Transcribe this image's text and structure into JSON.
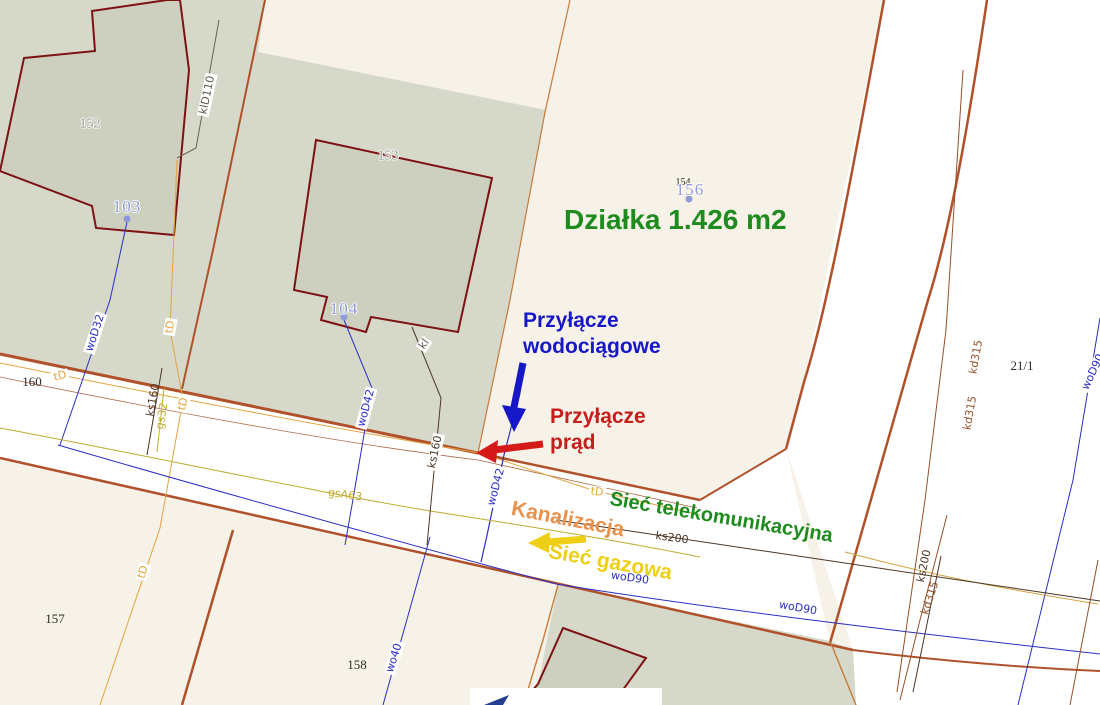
{
  "map": {
    "colors": {
      "plot_green": "#1d8b1d",
      "water_blue": "#1617c6",
      "power_red": "#c81d1d",
      "gas_yellow": "#eecf15",
      "sewer_orange": "#e8914a",
      "telecom_green": "#1d8b1d",
      "water_line": "#2a2ec0",
      "gas_line": "#bfab2e",
      "telecom_line": "#e2a43f",
      "sewer_line": "#4a3626",
      "storm_brown": "#94502a",
      "boundary_brown": "#b0512b",
      "dark": "#5f574b",
      "parcel_gray": "#98978d",
      "address_blue": "#8f9ad8",
      "black": "#2e2b28"
    },
    "annotations": [
      {
        "t": "Działka 1.426 m2",
        "x": 564,
        "y": 203,
        "c": "plot_green",
        "cls": "ann big",
        "name": "plot-area-label"
      },
      {
        "t": "Przyłącze\nwodociągowe",
        "x": 523,
        "y": 308,
        "c": "water_blue",
        "cls": "ann",
        "name": "water-connection-label"
      },
      {
        "t": "Przyłącze\nprąd",
        "x": 550,
        "y": 404,
        "c": "power_red",
        "cls": "ann",
        "name": "power-connection-label"
      },
      {
        "t": "Sieć telekomunikacyjna",
        "x": 612,
        "y": 487,
        "r": 9.5,
        "c": "telecom_green",
        "cls": "ann mid",
        "name": "telecom-network-label"
      },
      {
        "t": "Kanalizacja",
        "x": 514,
        "y": 496,
        "r": 11,
        "c": "sewer_orange",
        "cls": "ann",
        "name": "sewer-network-label"
      },
      {
        "t": "Sieć gazowa",
        "x": 551,
        "y": 539,
        "r": 10,
        "c": "gas_yellow",
        "cls": "ann",
        "name": "gas-network-label"
      }
    ],
    "labels": [
      {
        "t": "klD110",
        "x": 207,
        "y": 95,
        "r": -78,
        "c": "dark",
        "cls": "small chip",
        "name": "utility-label-kld110"
      },
      {
        "t": "kl",
        "x": 424,
        "y": 344,
        "r": -55,
        "c": "dark",
        "cls": "small chip",
        "name": "utility-label-kl"
      },
      {
        "t": "tD",
        "x": 60,
        "y": 376,
        "r": -15,
        "c": "telecom_line",
        "cls": "small chip",
        "name": "utility-label-td"
      },
      {
        "t": "tD",
        "x": 170,
        "y": 327,
        "r": -80,
        "c": "telecom_line",
        "cls": "small chip",
        "name": "utility-label-td"
      },
      {
        "t": "tD",
        "x": 183,
        "y": 404,
        "r": -75,
        "c": "telecom_line",
        "cls": "small chip",
        "name": "utility-label-td"
      },
      {
        "t": "tD",
        "x": 143,
        "y": 572,
        "r": -72,
        "c": "telecom_line",
        "cls": "small chip",
        "name": "utility-label-td"
      },
      {
        "t": "tD",
        "x": 597,
        "y": 492,
        "r": 8,
        "c": "telecom_line",
        "cls": "small chip",
        "name": "utility-label-td"
      },
      {
        "t": "woD32",
        "x": 95,
        "y": 333,
        "r": -72,
        "c": "water_line",
        "cls": "small chip",
        "name": "utility-label-wod32"
      },
      {
        "t": "woD42",
        "x": 366,
        "y": 408,
        "r": -75,
        "c": "water_line",
        "cls": "small chip",
        "name": "utility-label-wod42"
      },
      {
        "t": "woD42",
        "x": 496,
        "y": 487,
        "r": -75,
        "c": "water_line",
        "cls": "small chip",
        "name": "utility-label-wod42"
      },
      {
        "t": "woD90",
        "x": 630,
        "y": 578,
        "r": 8,
        "c": "water_line",
        "cls": "small chip",
        "name": "utility-label-wod90"
      },
      {
        "t": "woD90",
        "x": 798,
        "y": 608,
        "r": 10,
        "c": "water_line",
        "cls": "small chip",
        "name": "utility-label-wod90"
      },
      {
        "t": "woD90",
        "x": 1093,
        "y": 372,
        "r": -65,
        "c": "water_line",
        "cls": "small chip",
        "name": "utility-label-wod90"
      },
      {
        "t": "wo40",
        "x": 394,
        "y": 658,
        "r": -72,
        "c": "water_line",
        "cls": "small chip",
        "name": "utility-label-wo40"
      },
      {
        "t": "ks160",
        "x": 153,
        "y": 400,
        "r": -80,
        "c": "sewer_line",
        "cls": "small",
        "name": "utility-label-ks160"
      },
      {
        "t": "ks160",
        "x": 435,
        "y": 452,
        "r": -78,
        "c": "sewer_line",
        "cls": "small chip",
        "name": "utility-label-ks160"
      },
      {
        "t": "ks200",
        "x": 672,
        "y": 538,
        "r": 8,
        "c": "sewer_line",
        "cls": "small",
        "name": "utility-label-ks200"
      },
      {
        "t": "ks200",
        "x": 924,
        "y": 566,
        "r": -78,
        "c": "sewer_line",
        "cls": "small",
        "name": "utility-label-ks200"
      },
      {
        "t": "kd315",
        "x": 976,
        "y": 357,
        "r": -80,
        "c": "storm_brown",
        "cls": "small",
        "name": "utility-label-kd315"
      },
      {
        "t": "kd315",
        "x": 970,
        "y": 413,
        "r": -80,
        "c": "storm_brown",
        "cls": "small",
        "name": "utility-label-kd315"
      },
      {
        "t": "kd315",
        "x": 930,
        "y": 598,
        "r": -72,
        "c": "storm_brown",
        "cls": "small",
        "name": "utility-label-kd315"
      },
      {
        "t": "gs32",
        "x": 162,
        "y": 416,
        "r": -80,
        "c": "gas_line",
        "cls": "small",
        "name": "utility-label-gs32"
      },
      {
        "t": "gsA63",
        "x": 345,
        "y": 495,
        "r": 8,
        "c": "gas_line",
        "cls": "small",
        "name": "utility-label-gsa63"
      },
      {
        "t": "152",
        "x": 90,
        "y": 125,
        "c": "parcel_gray",
        "cls": "serifp",
        "name": "parcel-number-152"
      },
      {
        "t": "153",
        "x": 388,
        "y": 157,
        "c": "parcel_gray",
        "cls": "serifp",
        "name": "parcel-number-153"
      },
      {
        "t": "154",
        "x": 683,
        "y": 183,
        "c": "black",
        "cls": "tiny",
        "name": "parcel-number-154"
      },
      {
        "t": "156",
        "x": 690,
        "y": 190,
        "c": "address_blue",
        "cls": "addr",
        "name": "address-number-156"
      },
      {
        "t": "103",
        "x": 127,
        "y": 207,
        "c": "address_blue",
        "cls": "addr",
        "name": "address-number-103"
      },
      {
        "t": "104",
        "x": 344,
        "y": 309,
        "c": "address_blue",
        "cls": "addr",
        "name": "address-number-104"
      },
      {
        "t": "160",
        "x": 32,
        "y": 382,
        "c": "black",
        "cls": "blacknum",
        "name": "parcel-number-160"
      },
      {
        "t": "157",
        "x": 55,
        "y": 619,
        "c": "black",
        "cls": "blacknum",
        "name": "parcel-number-157"
      },
      {
        "t": "158",
        "x": 357,
        "y": 665,
        "c": "black",
        "cls": "blacknum",
        "name": "parcel-number-158"
      },
      {
        "t": "21/1",
        "x": 1022,
        "y": 366,
        "c": "black",
        "cls": "blacknum",
        "name": "parcel-number-21-1"
      }
    ]
  }
}
